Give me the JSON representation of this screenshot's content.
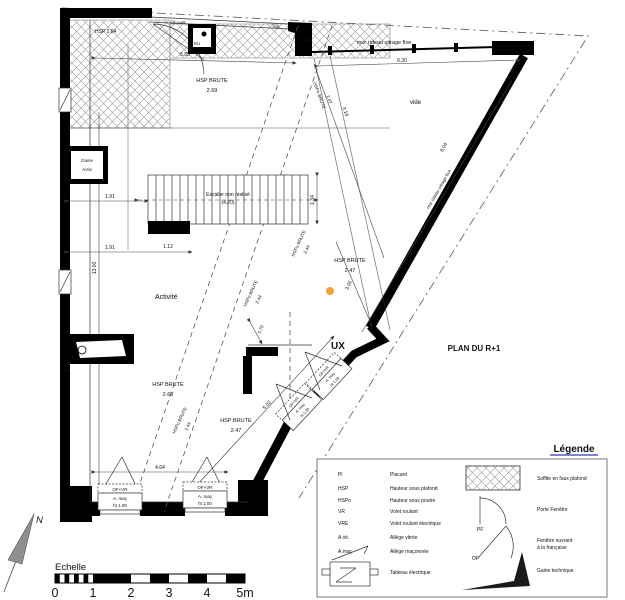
{
  "annotations": {
    "plan_title": "PLAN DU R+1",
    "mur_rideau": "mur rideau vitrage fixe",
    "hsp204": "HSP 2.04",
    "fixe": "fixe",
    "eu": "EU",
    "ep": "EP",
    "gaine1": "Gaine",
    "gaine2": "Activ",
    "escalier1": "Escalier non réalisé",
    "escalier2": "(4.20)",
    "activite": "Activité",
    "vide": "vide",
    "ux": "UX"
  },
  "heights": {
    "hsp": "HSP BRUTE",
    "hspo": "HSPo BRUTE",
    "v269": "2.69",
    "v247": "2.47",
    "v244": "2.44"
  },
  "dimensions": {
    "d585": "5.85",
    "d630": "6.30",
    "d604": "6.04",
    "d319": "3.19",
    "d134": "1.34",
    "d112": "1.12",
    "d191": "1.91",
    "d1300": "13.00",
    "d464": "4.64",
    "d502": "5.02",
    "d305": "3.05",
    "d070": "0.70"
  },
  "windows": {
    "of_vr": "OF+VR",
    "allege": "A. maç",
    "ht": "ht 1.00"
  },
  "scalebar": {
    "caption": "Echelle",
    "ticks": [
      "0",
      "1",
      "2",
      "3",
      "4",
      "5m"
    ]
  },
  "north": {
    "label": "N"
  },
  "legend": {
    "title": "Légende",
    "abbreviations": [
      {
        "abbr": "Pl",
        "desc": "Placard"
      },
      {
        "abbr": "HSP",
        "desc": "Hauteur sous plafond"
      },
      {
        "abbr": "HSPo",
        "desc": "Hauteur sous poutre"
      },
      {
        "abbr": "VR",
        "desc": "Volet roulant"
      },
      {
        "abbr": "VRE",
        "desc": "Volet roulant électrique"
      },
      {
        "abbr": "A.vit.",
        "desc": "Allège vitrée"
      },
      {
        "abbr": "A.maç",
        "desc": "Allège maçonnée"
      },
      {
        "abbr": "",
        "desc": "Tableau électrique"
      }
    ],
    "symbols": [
      {
        "label": "",
        "desc1": "Soffite en faux plafond",
        "desc2": ""
      },
      {
        "label": "PF",
        "desc1": "Porte Fenêtre",
        "desc2": ""
      },
      {
        "label": "OF",
        "desc1": "Fenêtre ouvrant",
        "desc2": "à la française"
      },
      {
        "label": "",
        "desc1": "Gaine technique",
        "desc2": ""
      }
    ]
  },
  "colors": {
    "accent_dot": "#F2A33C",
    "legend_title": "#00009C",
    "north_arrow": "#8F8F8F"
  }
}
